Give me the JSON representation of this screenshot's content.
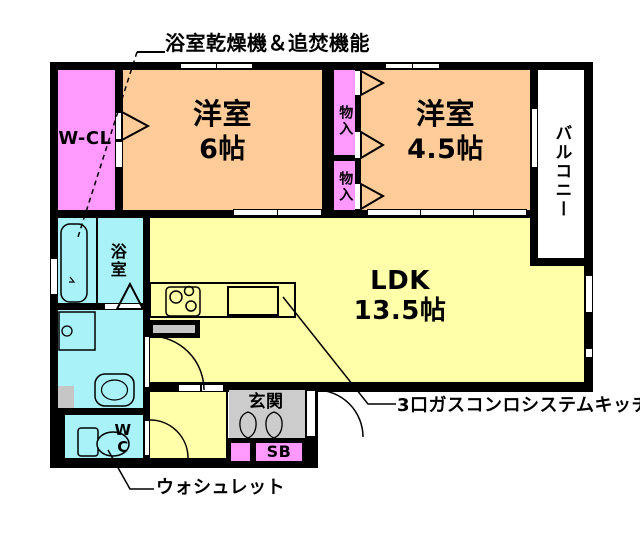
{
  "plan": {
    "rooms": {
      "wcl": {
        "label": "W-CL"
      },
      "room6": {
        "label": "洋室",
        "size": "6帖"
      },
      "storage_upper": {
        "label": "物入"
      },
      "storage_lower": {
        "label": "物入"
      },
      "room45": {
        "label": "洋室",
        "size": "4.5帖"
      },
      "balcony": {
        "label": "バルコニー"
      },
      "bath": {
        "label": "浴室"
      },
      "wc": {
        "label": "W\nC"
      },
      "ldk": {
        "label": "LDK",
        "size": "13.5帖"
      },
      "genkan": {
        "label": "玄関"
      },
      "shoebox": {
        "label": "SB"
      }
    },
    "annotations": {
      "bath_dryer": "浴室乾燥機＆追焚機能",
      "kitchen": "3口ガスコンロシステムキッチ",
      "washlet": "ウォシュレット"
    },
    "colors": {
      "room_peach": "#FFCC99",
      "closet_pink": "#FF99FF",
      "ldk_yellow": "#FFFFAA",
      "wet_cyan": "#A8F2F8",
      "entry_gray": "#CCCCCC",
      "wall_black": "#000000"
    }
  }
}
